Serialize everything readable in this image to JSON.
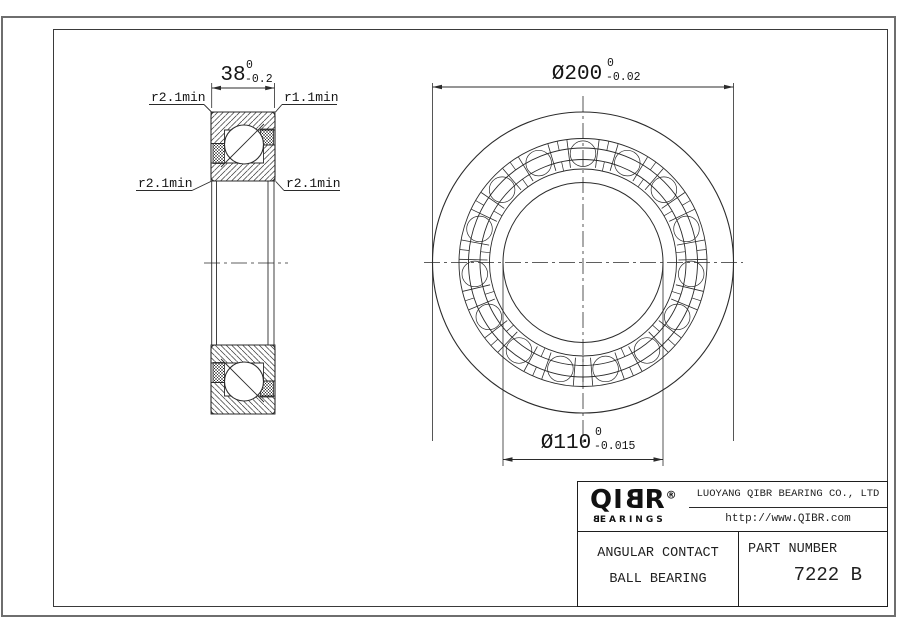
{
  "drawing": {
    "width_dim": {
      "value": "38",
      "upper_tol": "0",
      "lower_tol": "-0.2"
    },
    "od_dim": {
      "value": "Ø200",
      "upper_tol": "0",
      "lower_tol": "-0.02"
    },
    "bore_dim": {
      "value": "Ø110",
      "upper_tol": "0",
      "lower_tol": "-0.015"
    },
    "radius_labels": {
      "top_left": "r2.1min",
      "top_right": "r1.1min",
      "mid_left": "r2.1min",
      "mid_right": "r2.1min"
    }
  },
  "title_block": {
    "logo": {
      "brand": "QIBR",
      "registered": "®",
      "sub": "BEARINGS"
    },
    "company": "LUOYANG QIBR BEARING CO., LTD",
    "website": "http://www.QIBR.com",
    "product_line1": "ANGULAR CONTACT",
    "product_line2": "BALL BEARING",
    "part_number_label": "PART NUMBER",
    "part_number": "7222 B"
  },
  "colors": {
    "line": "#2b2b2b",
    "frame": "#6e6e6e"
  }
}
